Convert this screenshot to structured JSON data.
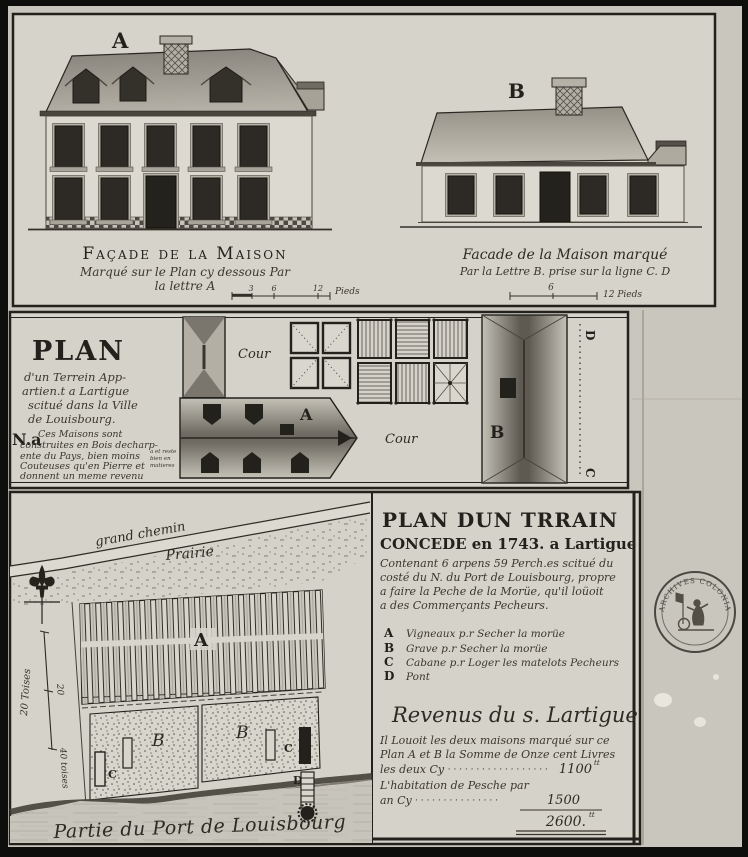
{
  "colors": {
    "paper": "#ccc9c0",
    "panel": "#d6d3ca",
    "ink": "#23211c",
    "photo_frame": "#0e0e0c"
  },
  "top_panel": {
    "facade_a": {
      "letter": "A",
      "title": "Façade de la Maison",
      "sub1": "Marqué sur le Plan cy dessous Par",
      "sub2": "la lettre A",
      "scale_ticks": [
        "3",
        "6",
        "12"
      ],
      "scale_unit": "Pieds"
    },
    "facade_b": {
      "letter": "B",
      "title": "Facade de la Maison marqué",
      "sub1": "Par la Lettre B. prise sur la ligne C. D",
      "scale_tick": "6",
      "scale_unit": "12 Pieds"
    }
  },
  "middle_panel": {
    "title": "PLAN",
    "title_lines": [
      "d'un Terrein App-",
      "artien.t a Lartigue",
      "scitué dans la Ville",
      "de Louisbourg."
    ],
    "note_label": "N.a",
    "note_lines": [
      "Ces Maisons sont",
      "construites en Bois decharp-",
      "ente du Pays, bien moins",
      "Couteuses qu'en Pierre et",
      "donnent un meme revenu"
    ],
    "side_note_lines": [
      "a et reste",
      "bien en",
      "matieres"
    ],
    "labels": {
      "cour_left": "Cour",
      "building_a": "A",
      "cour_right": "Cour",
      "building_b": "B",
      "line_d": "D",
      "line_c": "C"
    }
  },
  "bottom_left": {
    "road_label": "grand chemin",
    "prairie_label": "Prairie",
    "labels": {
      "a": "A",
      "b1": "B",
      "b2": "B",
      "c1": "C",
      "c2": "C",
      "d": "D"
    },
    "scale": {
      "along": "20 Toises",
      "mid": "20",
      "end": "40 toises"
    },
    "caption": "Partie du Port de Louisbourg"
  },
  "bottom_right": {
    "title1": "PLAN DUN TRRAIN",
    "title2": "CONCEDE en 1743. a Lartigue",
    "body_lines": [
      "Contenant 6 arpens 59 Perch.es scitué du",
      "costé du N. du Port de Louisbourg, propre",
      "a faire la Peche de la Morüe, qu'il loüoit",
      "a des Commerçants Pecheurs."
    ],
    "legend": [
      {
        "letter": "A",
        "text": "Vigneaux p.r Secher la morüe"
      },
      {
        "letter": "B",
        "text": "Grave p.r Secher la morüe"
      },
      {
        "letter": "C",
        "text": "Cabane p.r Loger les matelots Pecheurs"
      },
      {
        "letter": "D",
        "text": "Pont"
      }
    ],
    "revenue": {
      "title": "Revenus du s. Lartigue",
      "line1": "Il Louoit les deux maisons marqué sur ce",
      "line2": "Plan A et B la Somme de Onze cent Livres",
      "line3": "les deux Cy",
      "dots1": "· · · · · · · · · · · · · · · · · · ·",
      "amount1": "1100",
      "sup1": "tt",
      "line4": "L'habitation de Pesche par",
      "line5": "an Cy",
      "dots2": "· · · · · · · · · · · · · · ·",
      "amount2": "1500",
      "total": "2600.",
      "sup2": "tt"
    }
  },
  "stamp": {
    "text": "ARCHIVES COLONIALES"
  }
}
